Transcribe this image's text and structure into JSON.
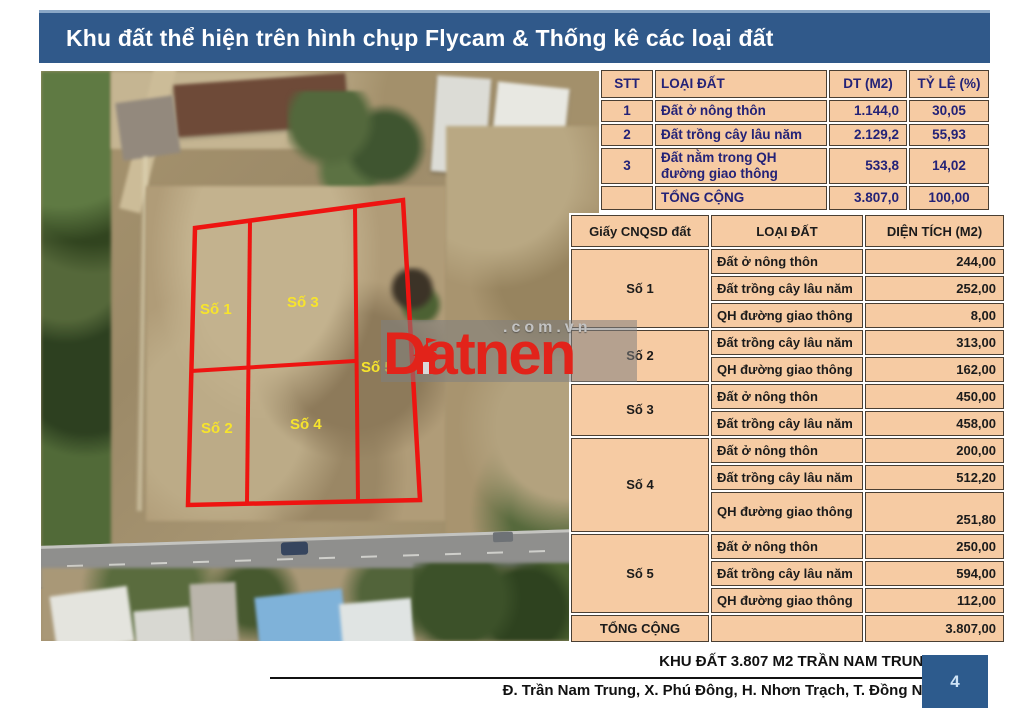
{
  "title": "Khu đất thể hiện trên hình chụp Flycam & Thống kê các loại đất",
  "photo": {
    "plot_labels": [
      "Số 1",
      "Số 2",
      "Số 3",
      "Số 4",
      "Số 5"
    ]
  },
  "watermark": {
    "brand": "Datnen",
    "suffix": ".com.vn"
  },
  "summary_table": {
    "headers": [
      "STT",
      "LOẠI ĐẤT",
      "DT (M2)",
      "TỶ LỆ (%)"
    ],
    "rows": [
      {
        "stt": "1",
        "type": "Đất ở nông thôn",
        "area": "1.144,0",
        "ratio": "30,05"
      },
      {
        "stt": "2",
        "type": "Đất trồng cây lâu năm",
        "area": "2.129,2",
        "ratio": "55,93"
      },
      {
        "stt": "3",
        "type": "Đất nằm trong QH đường giao thông",
        "area": "533,8",
        "ratio": "14,02"
      }
    ],
    "total": {
      "label": "TỔNG CỘNG",
      "area": "3.807,0",
      "ratio": "100,00"
    }
  },
  "detail_table": {
    "headers": [
      "Giấy CNQSD đất",
      "LOẠI ĐẤT",
      "DIỆN TÍCH (M2)"
    ],
    "groups": [
      {
        "name": "Số 1",
        "rows": [
          {
            "type": "Đất ở nông thôn",
            "area": "244,00"
          },
          {
            "type": "Đất trồng cây lâu năm",
            "area": "252,00"
          },
          {
            "type": "QH đường giao thông",
            "area": "8,00"
          }
        ]
      },
      {
        "name": "Số 2",
        "rows": [
          {
            "type": "Đất trồng cây lâu năm",
            "area": "313,00"
          },
          {
            "type": "QH đường giao thông",
            "area": "162,00"
          }
        ]
      },
      {
        "name": "Số 3",
        "rows": [
          {
            "type": "Đất ở nông thôn",
            "area": "450,00"
          },
          {
            "type": "Đất trồng cây lâu năm",
            "area": "458,00"
          }
        ]
      },
      {
        "name": "Số 4",
        "rows": [
          {
            "type": "Đất ở nông thôn",
            "area": "200,00"
          },
          {
            "type": "Đất trồng cây lâu năm",
            "area": "512,20"
          },
          {
            "type": "QH đường giao thông",
            "area": "251,80"
          }
        ]
      },
      {
        "name": "Số 5",
        "rows": [
          {
            "type": "Đất ở nông thôn",
            "area": "250,00"
          },
          {
            "type": "Đất trồng cây lâu năm",
            "area": "594,00"
          },
          {
            "type": "QH đường giao thông",
            "area": "112,00"
          }
        ]
      }
    ],
    "total": {
      "label": "TỔNG CỘNG",
      "area": "3.807,00"
    }
  },
  "footer": {
    "line1": "KHU ĐẤT 3.807 M2 TRẦN NAM TRUNG",
    "line2": "Đ. Trần Nam Trung, X. Phú Đông, H. Nhơn Trạch, T. Đồng Nai",
    "page": "4"
  },
  "colors": {
    "accent_blue": "#30598A",
    "table_fill": "#F6CBA3",
    "plot_red": "#EE1411",
    "label_yellow": "#F7E42C",
    "brand_red": "#E2231A"
  }
}
